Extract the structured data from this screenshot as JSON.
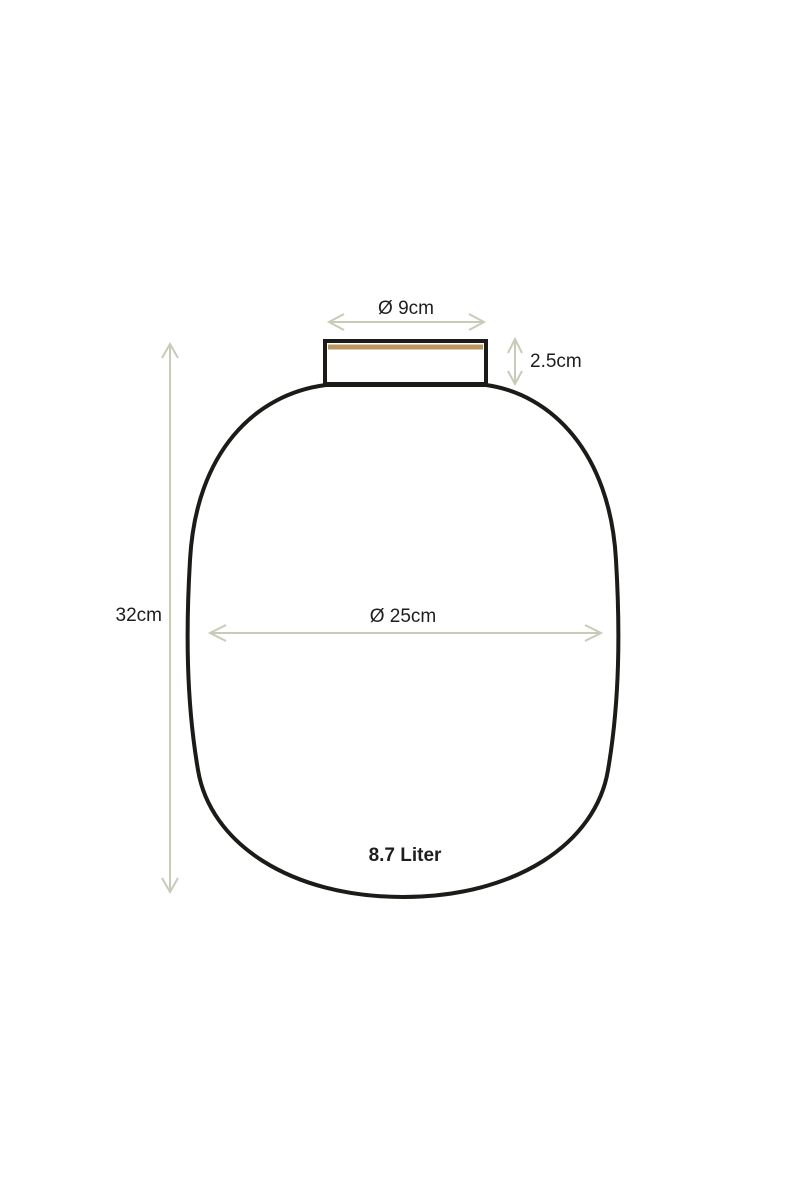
{
  "page": {
    "background_color": "#ffffff",
    "description": "Vase product dimension diagram"
  },
  "diagram": {
    "object": "vase",
    "colors": {
      "outline": "#1d1b17",
      "dimension_lines": "#c9cab8",
      "rim_accent": "#b9975f",
      "text": "#1e1e1e"
    },
    "dimensions": {
      "top_opening_diameter": "Ø 9cm",
      "neck_height": "2.5cm",
      "total_height": "32cm",
      "body_diameter": "Ø 25cm",
      "volume": "8.7 Liter"
    }
  }
}
